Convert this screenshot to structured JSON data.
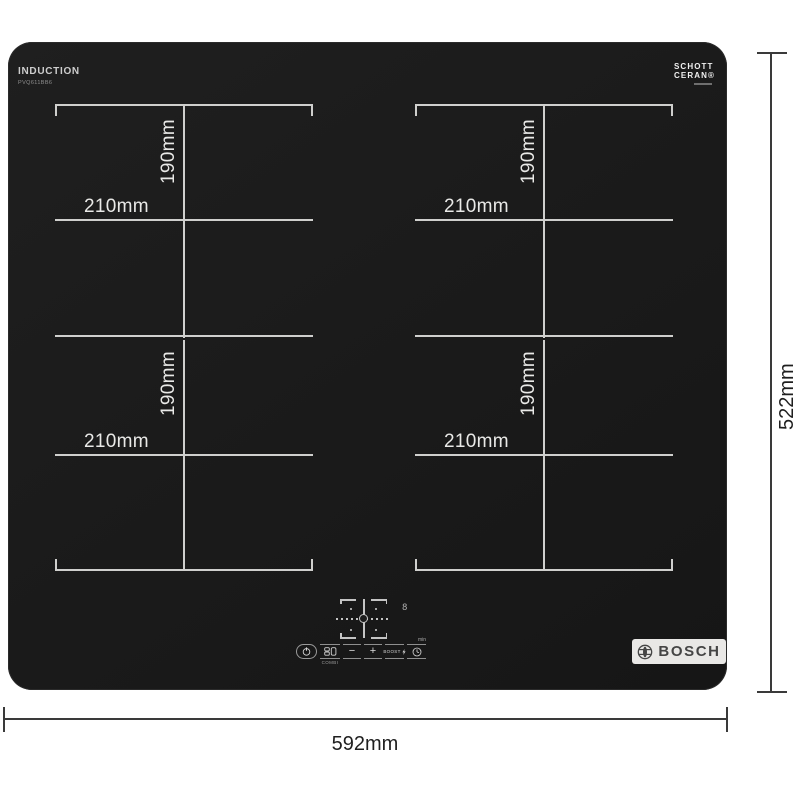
{
  "header": {
    "type_label": "INDUCTION",
    "model": "PVQ611BB6"
  },
  "logos": {
    "schott_line1": "SCHOTT",
    "schott_line2": "CERAN®",
    "bosch": "BOSCH"
  },
  "zones": [
    {
      "position": "top-left",
      "depth_label": "190mm",
      "width_label": "210mm"
    },
    {
      "position": "top-right",
      "depth_label": "190mm",
      "width_label": "210mm"
    },
    {
      "position": "bottom-left",
      "depth_label": "190mm",
      "width_label": "210mm"
    },
    {
      "position": "bottom-right",
      "depth_label": "190mm",
      "width_label": "210mm"
    }
  ],
  "dimensions": {
    "overall_width": "592mm",
    "overall_depth": "522mm"
  },
  "controls": {
    "display_digit": "8",
    "combi_label": "COMBI",
    "minus_label": "−",
    "plus_label": "+",
    "boost_label": "BOOST",
    "min_label": "min"
  },
  "icons": {
    "power": "power-icon",
    "timer": "clock-icon",
    "combi": "combi-zone-icon",
    "boost": "boost-icon",
    "bosch_symbol": "bosch-armature-icon",
    "zone_selector": "zone-selector-cross-icon"
  },
  "colors": {
    "hob_surface": "#1b1b1b",
    "zone_marking": "#cfcfcd",
    "dimension_line": "#3a3a3a",
    "label_on_hob": "#e9e9e7",
    "bosch_strip_bg": "#e9e8e6",
    "bosch_text": "#454545"
  }
}
